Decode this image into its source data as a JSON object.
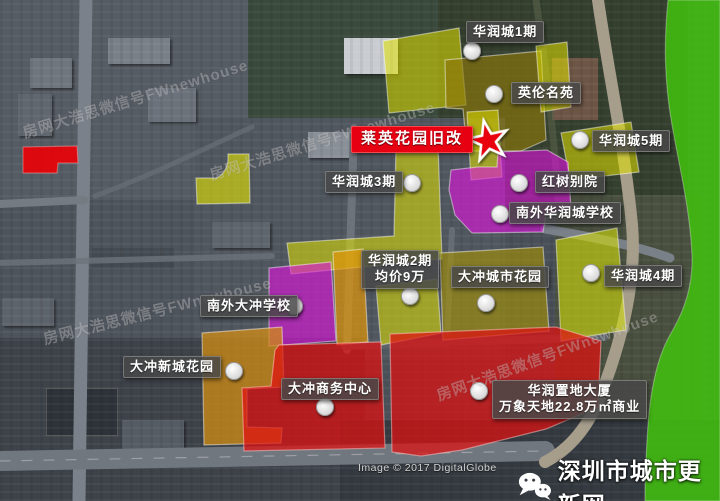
{
  "map_title": "深圳大冲片区旧改示意图",
  "zones": [
    {
      "id": "huarun-city-1",
      "label": "华润城1期",
      "color": "#d9d900"
    },
    {
      "id": "yinglun-mingyuan",
      "label": "英伦名苑",
      "color": "#8f7b0a"
    },
    {
      "id": "laiying-garden-redevelopment",
      "label": "莱英花园旧改",
      "color": "#e60012",
      "highlight": true,
      "marker": "red-star"
    },
    {
      "id": "huarun-city-5",
      "label": "华润城5期",
      "color": "#d9d900"
    },
    {
      "id": "huarun-city-3",
      "label": "华润城3期",
      "color": "#d9d900"
    },
    {
      "id": "hongshu-bieyuan",
      "label": "红树别院",
      "color": "#d414d4"
    },
    {
      "id": "nanwai-huaruncheng-school",
      "label": "南外华润城学校",
      "color": "#d414d4"
    },
    {
      "id": "huarun-city-2",
      "label": "华润城2期",
      "sub_label": "均价9万",
      "color": "#d9d900"
    },
    {
      "id": "dachong-city-garden",
      "label": "大冲城市花园",
      "color": "#a79105"
    },
    {
      "id": "huarun-city-4",
      "label": "华润城4期",
      "color": "#ccd80a"
    },
    {
      "id": "nanwai-dachong-school",
      "label": "南外大冲学校",
      "color": "#d414d4"
    },
    {
      "id": "dachong-xincheng-garden",
      "label": "大冲新城花园",
      "color": "#d28c14"
    },
    {
      "id": "dachong-business-center",
      "label": "大冲商务中心",
      "color": "#dd1010"
    },
    {
      "id": "huarun-zhidi-tower",
      "label": "华润置地大厦",
      "sub_label": "万象天地22.8万㎡商业",
      "color": "#dd1010"
    }
  ],
  "watermark": {
    "text": "房网大浩思微信号FWnewhouse"
  },
  "credits": {
    "imagery_credit": "Image © 2017 DigitalGlobe"
  },
  "branding": {
    "site_name": "深圳市城市更新网",
    "icon": "wechat-icon"
  },
  "colors": {
    "highlight_red": "#e60012",
    "zone_yellow": "#d9d900",
    "zone_magenta": "#d414d4",
    "zone_orange": "#d28c14",
    "zone_red": "#dd1010",
    "greenbelt": "#3fbe0f",
    "label_bg": "#484848"
  }
}
